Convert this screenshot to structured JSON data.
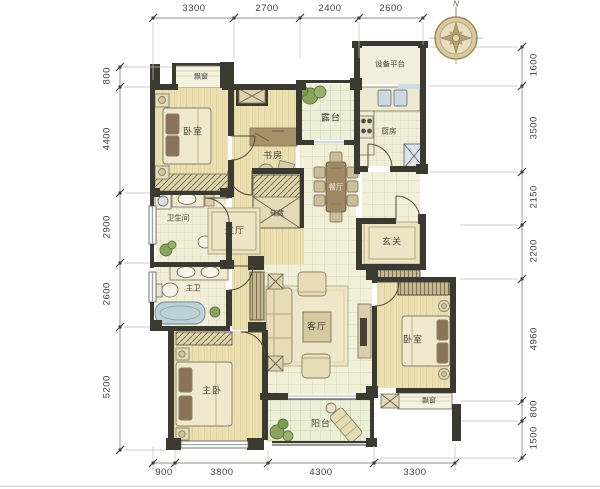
{
  "compass": {
    "north_label": "N"
  },
  "dimensions": {
    "top": [
      "3300",
      "2700",
      "2400",
      "2600"
    ],
    "bottom": [
      "900",
      "3800",
      "4300",
      "3300"
    ],
    "left": [
      "800",
      "4400",
      "2900",
      "2600",
      "5200"
    ],
    "right": [
      "1600",
      "3500",
      "2150",
      "2200",
      "4960",
      "800",
      "1500"
    ]
  },
  "rooms": {
    "bay_window_top": "飘窗",
    "bedroom_top": "卧室",
    "study": "书房",
    "terrace": "露台",
    "equipment_platform": "设备平台",
    "kitchen": "厨房",
    "dining": "餐厅",
    "entry": "玄关",
    "bathroom": "卫生间",
    "hallway": "过厅",
    "storage": "储藏",
    "master_bath": "主卫",
    "master_bedroom": "主卧",
    "living": "客厅",
    "balcony": "阳台",
    "bedroom_right": "卧室",
    "bay_window_bottom": "飘窗"
  },
  "colors": {
    "wall": "#3a3a30",
    "wood_floor": "#ece1b2",
    "tile_floor": "#f3f0da",
    "bathtub": "#bdd2d8",
    "plant": "#8aa45e"
  }
}
